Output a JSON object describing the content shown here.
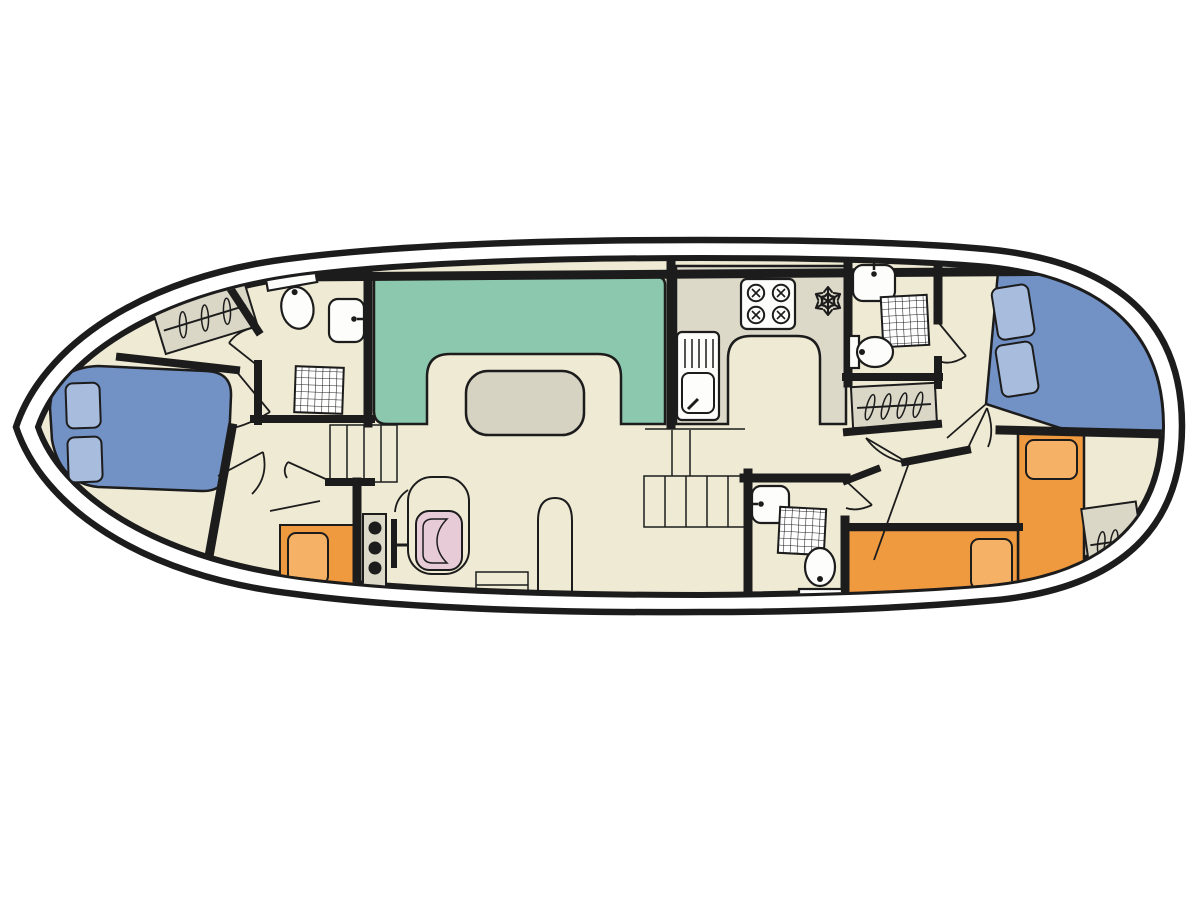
{
  "diagram": {
    "kind": "floorplan",
    "subject": "canal-boat-deck-plan",
    "orientation": "bow-left-stern-right"
  },
  "colors": {
    "background": "#ffffff",
    "hull_line": "#1c1c1c",
    "wall": "#1c1c1c",
    "deck": "#efead4",
    "dinette_teal": "#8cc8ae",
    "table_gray": "#d6d3c3",
    "counter_gray": "#dcd9c9",
    "bed_blue": "#7291c5",
    "pillow_blue": "#a8bcde",
    "bed_orange": "#f09a40",
    "pillow_orange": "#f5b166",
    "chair_pink": "#e7cbd6",
    "wardrobe_gray": "#dad7c7",
    "fixture_white": "#fdfdfb"
  },
  "inventory": {
    "double_beds": 2,
    "single_beds": 2,
    "seat_cushions": 2,
    "dinettes": 1,
    "tables": 1,
    "galleys": 1,
    "stove_burners": 4,
    "fridge_freezer_icons": 1,
    "bathrooms": 3,
    "toilets": 3,
    "showers": 3,
    "washbasins": 3,
    "galley_sinks": 1,
    "wardrobes": 3,
    "staircases": 2,
    "helm_stations": 1
  }
}
